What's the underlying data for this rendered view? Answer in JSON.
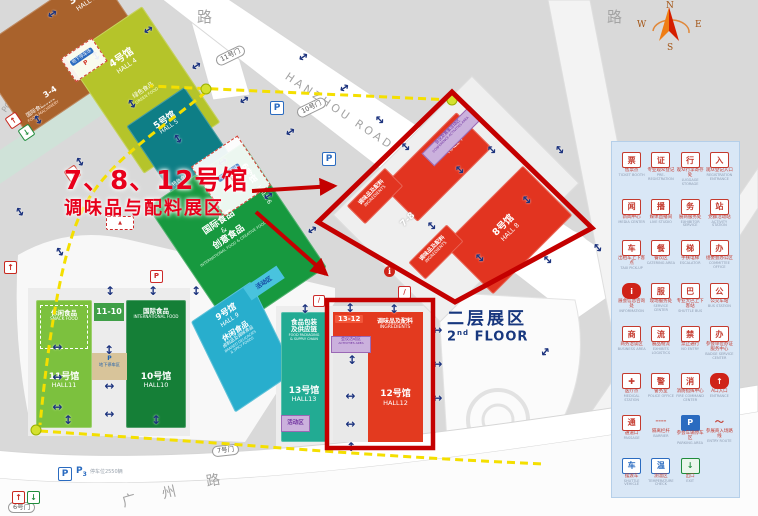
{
  "annotation": {
    "line1": "7、8、12号馆",
    "line2": "调味品与配料展区"
  },
  "second_floor": {
    "cn": "二层展区",
    "num": "2",
    "sup": "nd",
    "en": " FLOOR"
  },
  "halls": {
    "h3": {
      "name": "3号馆",
      "en": "HALL 3",
      "sub": "国际食品机械",
      "sub_en": "FOOD MACHINERY"
    },
    "h4": {
      "name": "4号馆",
      "en": "HALL 4",
      "sub": "绿色食品",
      "sub_en": "GREEN FOOD"
    },
    "h5": {
      "name": "5号馆",
      "en": "HALL 5",
      "sub": "特色食品",
      "sub_en": "LOCAL FOOD"
    },
    "h6": {
      "name": "6号馆",
      "en": "HALL 6",
      "sub1": "国际食品",
      "amp": "&",
      "sub2": "创意食品",
      "sub_en": "INTERNATIONAL FOOD & CREATIVE FOOD"
    },
    "h7": {
      "name": "7号馆",
      "en": "HALL 7"
    },
    "h8": {
      "name": "8号馆",
      "en": "HALL 8"
    },
    "h9": {
      "name": "9号馆",
      "en": "HALL 9",
      "sub": "休闲食品",
      "sub2": "卤制品及调味食品",
      "sub_en1": "BRAISED DELICACIES",
      "sub_en2": "& SPICY FOODS"
    },
    "h10": {
      "name": "10号馆",
      "en": "HALL10",
      "sub": "国际食品",
      "sub_en": "INTERNATIONAL FOOD"
    },
    "h11": {
      "name": "11号馆",
      "en": "HALL11",
      "sub": "休闲食品",
      "sub_en": "SNACK FOOD"
    },
    "h12": {
      "name": "12号馆",
      "en": "HALL12",
      "sub": "调味品及配料",
      "sub_en": "INGREDIENTS"
    },
    "h13": {
      "name": "13号馆",
      "en": "HALL13",
      "sub1": "食品包装",
      "sub2": "及供应链",
      "sub_en1": "FOOD PACKAGING",
      "sub_en2": "& SUPPLY CHAIN"
    }
  },
  "ingredients_label": {
    "cn": "调味品及配料",
    "en": "INGREDIENTS"
  },
  "connectors": {
    "c34": "3-4",
    "c78": "7-8",
    "c1110": "11-10",
    "c1312": "13-12"
  },
  "zones": {
    "activity": "活动区",
    "conference": {
      "cn": "会议及赛事活动区",
      "en": "CONFERENCE ACTIVITIES AREA"
    },
    "meeting": {
      "cn": "会议活动区",
      "en": "ACTIVITIES AREA"
    },
    "underground_parking": "地下停车场",
    "underground_parking2": "地下停车区"
  },
  "roads": {
    "hanzhou": "HANZHOU ROAD",
    "lu": "路",
    "lu2": "路",
    "guangzhou": [
      "广",
      "州",
      "路"
    ],
    "partial": "POR"
  },
  "gates": {
    "g6": "6号门",
    "g7": "7号门",
    "g10": "10号门",
    "g11": "11号门"
  },
  "parking": {
    "p": "P",
    "p3": "P",
    "p3sub": "3",
    "note": "停车位2550辆",
    "icons": [
      [
        270,
        101
      ],
      [
        322,
        152
      ],
      [
        58,
        467
      ]
    ]
  },
  "compass": {
    "n": "N",
    "s": "S",
    "e": "E",
    "w": "W"
  },
  "legend": {
    "items": [
      {
        "cn": "售票点",
        "en": "TICKET BOOTH",
        "glyph": "票",
        "variant": "r",
        "icon": "ticket-icon"
      },
      {
        "cn": "专业观众登记",
        "en": "PRE-REGISTRATION",
        "glyph": "证",
        "variant": "r",
        "icon": "badge-icon"
      },
      {
        "cn": "观众行李寄存处",
        "en": "LUGGAGE STORAGE",
        "glyph": "行",
        "variant": "r",
        "icon": "luggage-icon"
      },
      {
        "cn": "观众登记入口",
        "en": "REGISTRATION ENTRANCE",
        "glyph": "入",
        "variant": "r",
        "icon": "entrance-registration-icon"
      },
      {
        "cn": "新闻中心",
        "en": "MEDIA CENTER",
        "glyph": "闻",
        "variant": "r",
        "icon": "media-center-icon"
      },
      {
        "cn": "媒体直播间",
        "en": "LIVE STUDIO",
        "glyph": "播",
        "variant": "r",
        "icon": "camera-icon"
      },
      {
        "cn": "展商服务处",
        "en": "EXHIBITOR SERVICE",
        "glyph": "务",
        "variant": "r",
        "icon": "service-hand-icon"
      },
      {
        "cn": "党群活动站",
        "en": "ACTIVITY STATION",
        "glyph": "站",
        "variant": "r",
        "icon": "station-icon"
      },
      {
        "cn": "出租车上下客点",
        "en": "TAXI PICK-UP",
        "glyph": "车",
        "variant": "r",
        "icon": "taxi-icon"
      },
      {
        "cn": "餐饮区",
        "en": "CATERING AREA",
        "glyph": "餐",
        "variant": "r",
        "icon": "catering-icon"
      },
      {
        "cn": "手扶电梯",
        "en": "ESCALATOR",
        "glyph": "梯",
        "variant": "r",
        "icon": "escalator-icon"
      },
      {
        "cn": "组委会办公区",
        "en": "COMMITTEE OFFICE",
        "glyph": "办",
        "variant": "r",
        "icon": "office-icon"
      },
      {
        "cn": "展会信息咨询处",
        "en": "INFORMATION",
        "glyph": "i",
        "variant": "rf",
        "icon": "info-icon"
      },
      {
        "cn": "现场服务处",
        "en": "SERVICE CENTER",
        "glyph": "服",
        "variant": "r",
        "icon": "service-center-icon"
      },
      {
        "cn": "专业大巴上下客站",
        "en": "SHUTTLE BUS",
        "glyph": "巴",
        "variant": "r",
        "icon": "shuttle-bus-icon"
      },
      {
        "cn": "公交车站",
        "en": "BUS STATION",
        "glyph": "公",
        "variant": "r",
        "icon": "bus-station-icon"
      },
      {
        "cn": "商务洽谈区",
        "en": "BUSINESS AREA",
        "glyph": "商",
        "variant": "r",
        "icon": "business-icon"
      },
      {
        "cn": "展品物流",
        "en": "EXHIBITS LOGISTICS",
        "glyph": "流",
        "variant": "r",
        "icon": "logistics-truck-icon"
      },
      {
        "cn": "禁止通行",
        "en": "NO ENTRY",
        "glyph": "禁",
        "variant": "r",
        "icon": "no-entry-icon"
      },
      {
        "cn": "参会单位办证服务中心",
        "en": "BADGE SERVICE CENTER",
        "glyph": "办",
        "variant": "r",
        "icon": "badge-service-icon"
      },
      {
        "cn": "医疗点",
        "en": "MEDICAL STATION",
        "glyph": "✚",
        "variant": "r",
        "icon": "medical-cross-icon"
      },
      {
        "cn": "警务室",
        "en": "POLICE OFFICE",
        "glyph": "警",
        "variant": "r",
        "icon": "police-icon"
      },
      {
        "cn": "消防指挥中心",
        "en": "FIRE COMMAND CENTER",
        "glyph": "消",
        "variant": "r",
        "icon": "fire-command-icon"
      },
      {
        "cn": "A口入口",
        "en": "ENTRANCE",
        "glyph": "↑",
        "variant": "rf",
        "icon": "entrance-a-icon"
      },
      {
        "cn": "通道口",
        "en": "PASSAGE",
        "glyph": "通",
        "variant": "r",
        "icon": "passage-icon"
      },
      {
        "cn": "隔离栏杆",
        "en": "BARRIER",
        "glyph": "╌╌",
        "variant": "p",
        "icon": "barrier-icon"
      },
      {
        "cn": "参会车辆停车区",
        "en": "PARKING AREA",
        "glyph": "P",
        "variant": "bf",
        "icon": "parking-icon"
      },
      {
        "cn": "参展商入场路线",
        "en": "ENTRY ROUTE",
        "glyph": "～",
        "variant": "p",
        "icon": "route-swoosh-icon"
      },
      {
        "cn": "摆渡车",
        "en": "SHUTTLE VEHICLE",
        "glyph": "车",
        "variant": "b",
        "icon": "shuttle-vehicle-icon"
      },
      {
        "cn": "测温区",
        "en": "TEMPERATURE CHECK",
        "glyph": "温",
        "variant": "b",
        "icon": "temperature-icon"
      },
      {
        "cn": "出口",
        "en": "EXIT",
        "glyph": "↓",
        "variant": "g",
        "icon": "exit-icon"
      }
    ]
  },
  "map_arrows": [
    [
      52,
      14,
      56
    ],
    [
      96,
      56,
      -34
    ],
    [
      148,
      30,
      56
    ],
    [
      196,
      66,
      56
    ],
    [
      244,
      100,
      56
    ],
    [
      290,
      132,
      56
    ],
    [
      132,
      104,
      -34
    ],
    [
      178,
      139,
      -34
    ],
    [
      80,
      162,
      -34
    ],
    [
      38,
      120,
      -34
    ],
    [
      222,
      162,
      56
    ],
    [
      268,
      196,
      56
    ],
    [
      312,
      230,
      56
    ],
    [
      20,
      212,
      -34
    ],
    [
      60,
      252,
      -34
    ],
    [
      303,
      57,
      56
    ],
    [
      344,
      88,
      56
    ],
    [
      57,
      347,
      90
    ],
    [
      57,
      377,
      90
    ],
    [
      57,
      407,
      90
    ],
    [
      110,
      291,
      0
    ],
    [
      153,
      291,
      0
    ],
    [
      196,
      291,
      0
    ],
    [
      109,
      350,
      0
    ],
    [
      109,
      386,
      90
    ],
    [
      109,
      414,
      90
    ],
    [
      68,
      420,
      0
    ],
    [
      156,
      420,
      0
    ],
    [
      305,
      309,
      0
    ],
    [
      350,
      308,
      0
    ],
    [
      394,
      309,
      0
    ],
    [
      352,
      360,
      0
    ],
    [
      350,
      396,
      90
    ],
    [
      350,
      424,
      90
    ],
    [
      351,
      447,
      0
    ],
    [
      437,
      330,
      90
    ],
    [
      437,
      364,
      90
    ],
    [
      437,
      398,
      90
    ],
    [
      406,
      147,
      -45
    ],
    [
      380,
      120,
      -45
    ],
    [
      460,
      170,
      -45
    ],
    [
      492,
      150,
      -45
    ],
    [
      527,
      200,
      -45
    ],
    [
      432,
      226,
      -45
    ],
    [
      480,
      258,
      -45
    ],
    [
      548,
      260,
      -45
    ],
    [
      560,
      150,
      -40
    ],
    [
      598,
      248,
      -40
    ],
    [
      545,
      352,
      40
    ]
  ],
  "access_icons": [
    {
      "x": 7,
      "y": 114,
      "rot": -34,
      "type": "ent"
    },
    {
      "x": 66,
      "y": 167,
      "rot": -34,
      "type": "ent"
    },
    {
      "x": 4,
      "y": 261,
      "rot": 0,
      "type": "ent"
    },
    {
      "x": 12,
      "y": 491,
      "rot": 0,
      "type": "ent"
    },
    {
      "x": 20,
      "y": 126,
      "rot": -34,
      "type": "exi"
    },
    {
      "x": 27,
      "y": 491,
      "rot": 0,
      "type": "exi"
    }
  ]
}
